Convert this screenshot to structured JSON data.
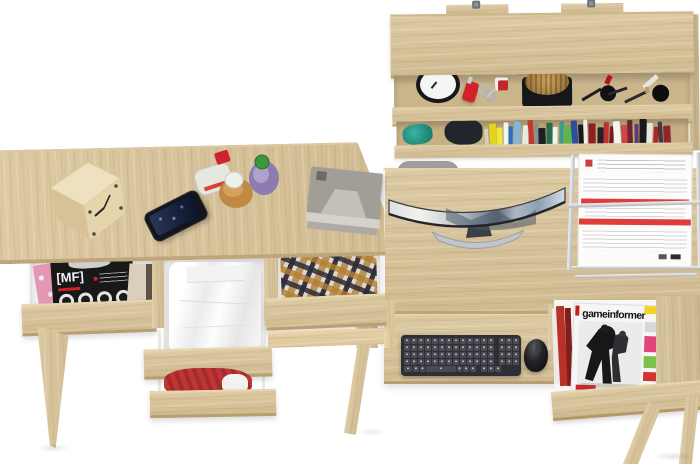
{
  "scene": {
    "subject": "Two-desk home office set with wall shelf, top view product photo",
    "background": "#ffffff"
  },
  "palette": {
    "oak": "#d8c49c",
    "oak_light": "#e7d7b0",
    "oak_dark": "#b89e72",
    "drawer_interior": "#f3f2f0",
    "chair_grey": "#9e9e9e",
    "paper_red": "#e23b3b"
  },
  "left_desk": {
    "surface_items": [
      {
        "id": "cube-clock",
        "label": "wooden cube clock"
      },
      {
        "id": "smartphone",
        "label": "smartphone"
      },
      {
        "id": "perfume-set",
        "label": "three perfume bottles"
      },
      {
        "id": "organizer",
        "label": "grey desk organizer"
      }
    ],
    "drawers": [
      {
        "id": "drawer-magazines",
        "contents": "music magazines",
        "magazine_title": "[MF]"
      },
      {
        "id": "drawer-white-shirt",
        "contents": "folded white shirt"
      },
      {
        "id": "drawer-red-garment",
        "contents": "red garment"
      },
      {
        "id": "drawer-plaid-shirt",
        "contents": "plaid shirt"
      }
    ]
  },
  "wall_shelf": {
    "upper_row_items": [
      "alarm clock",
      "red pocket knife",
      "key ring with red fob",
      "woven basket on black tray",
      "cosmetic brushes",
      "powder brush"
    ],
    "lower_row_items": [
      "teal cloth",
      "black pouch",
      "row of books"
    ],
    "book_colors": [
      "#d8d0b4",
      "#e5d41f",
      "#f0e93c",
      "#f4f4ef",
      "#2f6db5",
      "#85b6da",
      "#e9e9e4",
      "#c9372c",
      "#8a8f94",
      "#1d1f24",
      "#2a6b4f",
      "#f2f2ee",
      "#37a08c",
      "#57b94a",
      "#2b4f9e",
      "#17181c",
      "#ededeb",
      "#8e1f23",
      "#212226",
      "#c03030",
      "#7c1820",
      "#f4f4f2",
      "#d04545",
      "#6e2430",
      "#5f3a78",
      "#1a1a1e",
      "#e6e6e2",
      "#b0252a",
      "#3a3a40",
      "#94232b"
    ]
  },
  "right_desk": {
    "monitor": {
      "label": "curved widescreen monitor",
      "wallpaper": "mountain landscape"
    },
    "chair": {
      "label": "office chair backrest",
      "color": "#9e9e9e"
    },
    "document_tray": {
      "label": "wire document tray with invoices",
      "paper_accent": "#e23b3b"
    },
    "keyboard": {
      "label": "wireless keyboard",
      "color": "#2e2f34"
    },
    "mouse": {
      "label": "wireless mouse",
      "color": "#17181a"
    },
    "magazine_rack": {
      "magazine_title": "gameinformer",
      "tag_color": "#f2d422",
      "side_bar_colors": [
        "#d8d8d6",
        "#e0457b",
        "#7cc24a",
        "#d23333"
      ]
    }
  }
}
